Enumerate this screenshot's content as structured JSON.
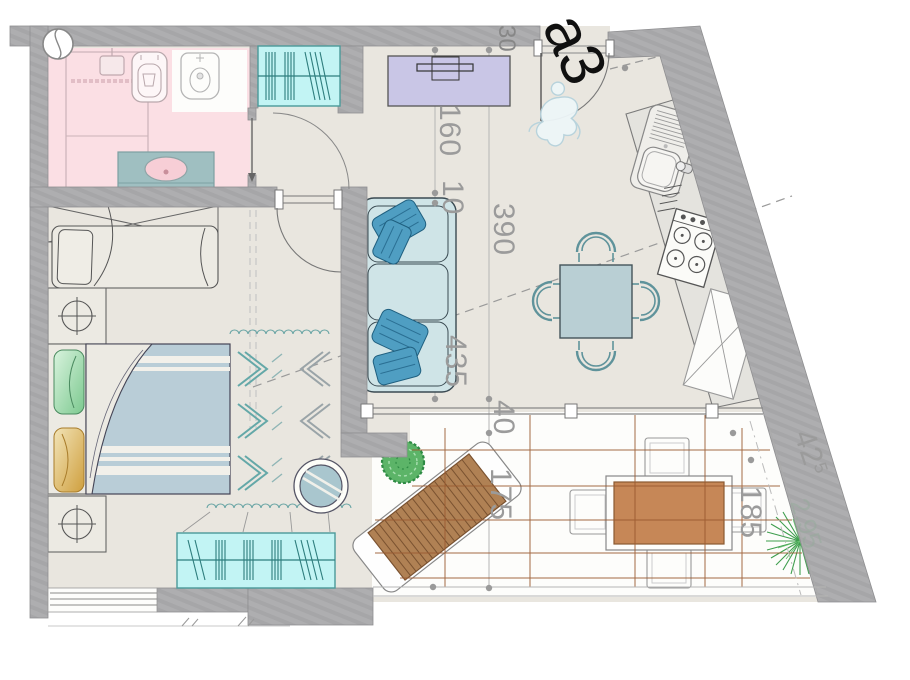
{
  "sheet": {
    "label": "a3"
  },
  "dimensions": {
    "wall_thickness": "30",
    "tv_wall": "160",
    "offset": "10",
    "living_width": "390",
    "living_length": "435",
    "terrace_offset": "40",
    "terrace_lounge": "175",
    "terrace_table": "185",
    "terrace_side_main": "42",
    "terrace_side_sup": "5",
    "terrace_side_faint": "2.95"
  },
  "icons": {
    "section_marker": "circle-with-s-curve",
    "person_figure": "sketched-walking-person",
    "bush": "round-shrub",
    "grass_plant": "radial-grass",
    "lamp_symbol": "circle-cross"
  },
  "colors": {
    "wall": "#ababad",
    "floor": "#e9e6df",
    "bathroom_floor": "#fbdfe4",
    "radiator": "#c2f4f4",
    "sofa": "#cfe4e7",
    "pillow_accent": "#4f9ec2",
    "tv_unit": "#c9c6e6",
    "dining_table": "#b9cfd4",
    "bed_duvet": "#b9cdd7",
    "wood_lounger": "#b08154",
    "terrace_table_top": "#c68757",
    "plant_green": "#4caf50",
    "deck_line": "#9b5a30",
    "dimension_text": "#9b9b9b",
    "sheet_label": "#111111"
  }
}
